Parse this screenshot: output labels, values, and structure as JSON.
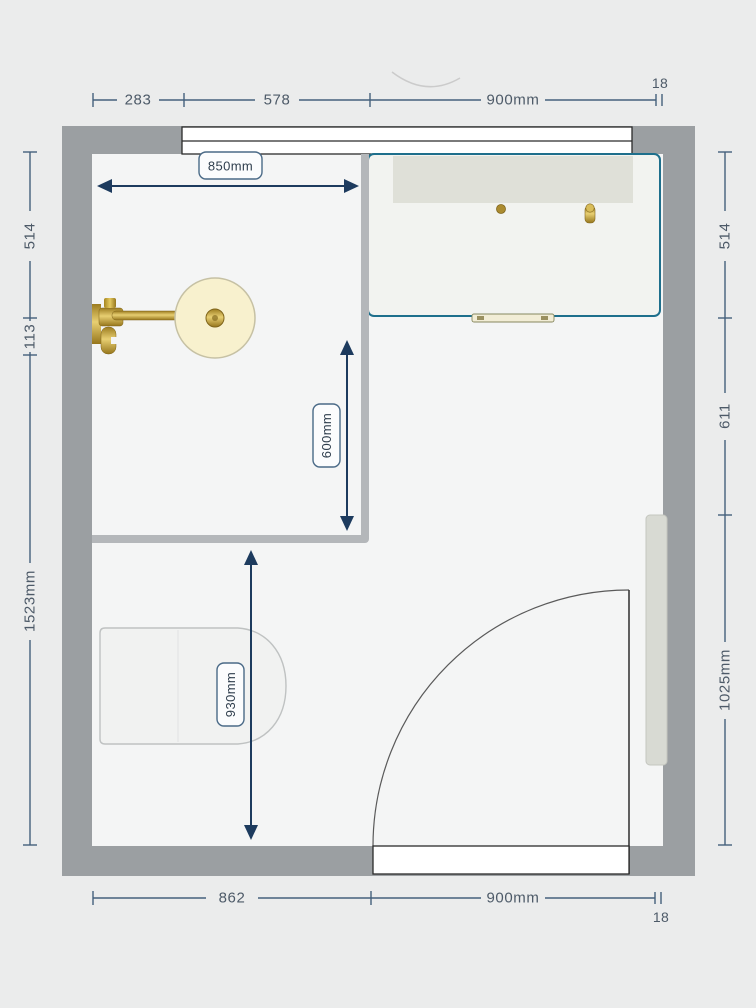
{
  "app": {
    "view_name": "bathroom-floor-plan",
    "units": "mm"
  },
  "dimensions": {
    "top": {
      "seg1": "283",
      "seg2": "578",
      "seg3": "900mm",
      "wall": "18"
    },
    "bottom": {
      "seg1": "862",
      "seg2": "900mm",
      "wall": "18"
    },
    "left": {
      "seg1": "514",
      "seg2": "113",
      "seg3": "1523mm"
    },
    "right": {
      "seg1": "514",
      "seg2": "611",
      "seg3": "1025mm"
    }
  },
  "chips": {
    "shower_width": "850mm",
    "shower_depth": "600mm",
    "toilet_clearance": "930mm"
  },
  "fixtures": {
    "window": "window",
    "vanity": "vanity-unit-with-basin-taps",
    "shower_enclosure": "shower-enclosure",
    "shower_head": "wall-mounted-brass-shower-head",
    "toilet": "back-to-wall-toilet",
    "radiator": "towel-radiator",
    "door": "door-with-quarter-swing"
  },
  "colors": {
    "background": "#ebecec",
    "room_floor": "#f4f5f5",
    "wall": "#9b9fa2",
    "partition": "#b4b7ba",
    "dimension_line": "#44607c",
    "dimension_text": "#4d5a68",
    "arrow": "#1d3b5e",
    "vanity_outline": "#1e6f8c",
    "counter_band": "#dfe0d8",
    "brass": "#c9a837",
    "shower_head_face": "#f8f1ce",
    "radiator_fill": "#d8dad3"
  }
}
